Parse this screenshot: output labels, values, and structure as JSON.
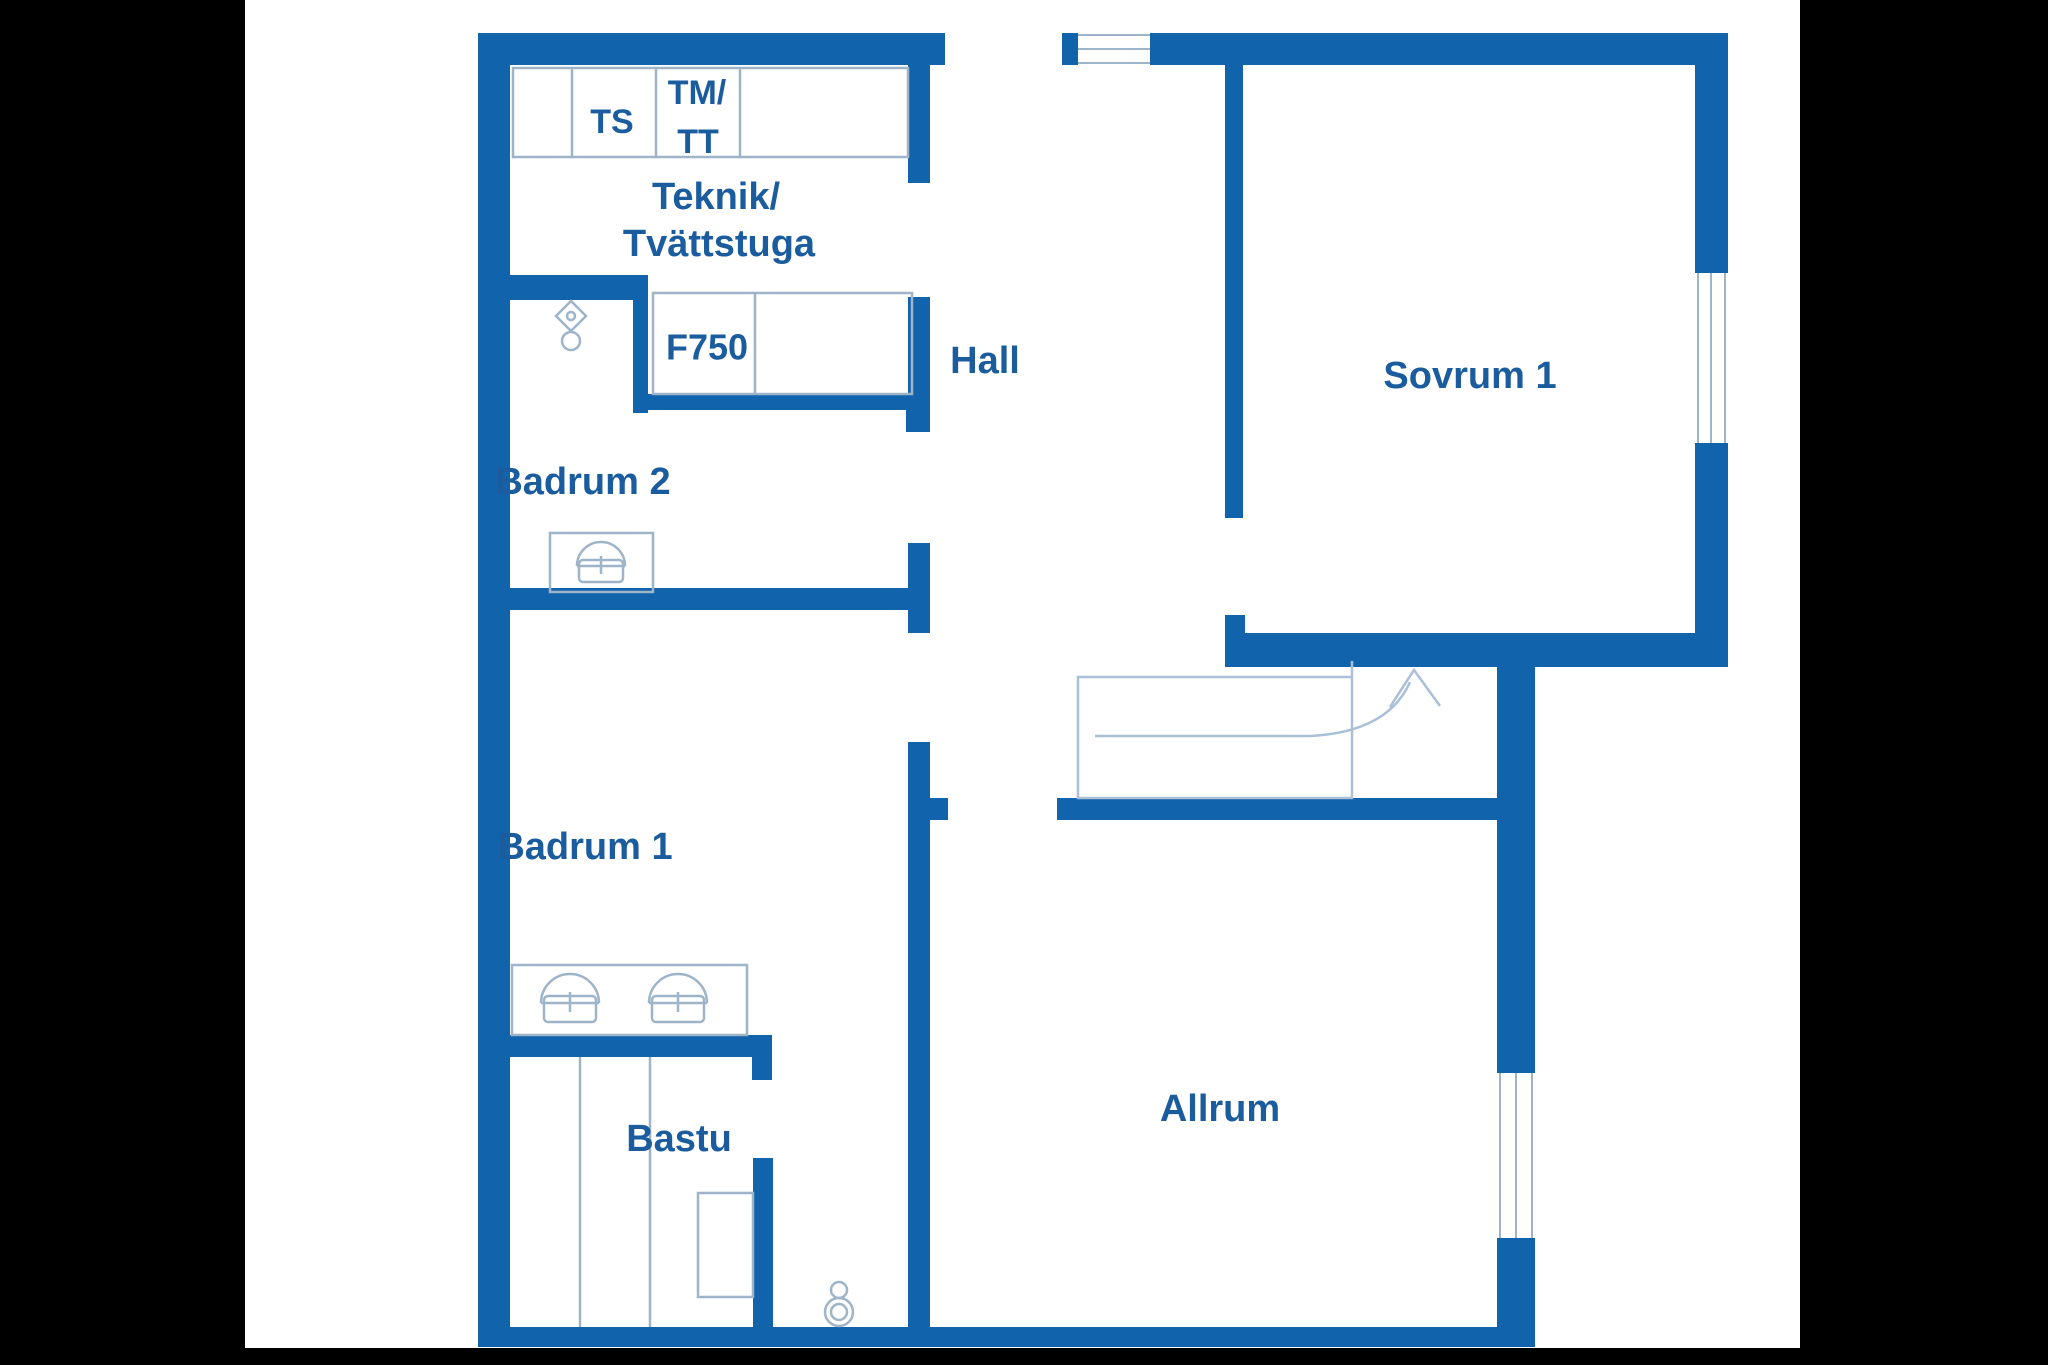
{
  "document": {
    "type": "floor-plan-drawing",
    "style": "blue line drawing on white, letterboxed with black bars"
  },
  "colors": {
    "wall": "#1163ac",
    "text": "#1b5c9e",
    "thin_outline": "#9db4c9",
    "stair_line": "#a9c0d6",
    "background": "#ffffff",
    "letterbox": "#000000"
  },
  "labels": {
    "teknik_line1": "Teknik/",
    "teknik_line2": "Tvättstuga",
    "hall": "Hall",
    "sovrum1": "Sovrum 1",
    "badrum2": "Badrum 2",
    "badrum1": "Badrum 1",
    "bastu": "Bastu",
    "allrum": "Allrum",
    "cab_ts": "TS",
    "cab_tm": "TM/",
    "cab_tt": "TT",
    "f750": "F750"
  },
  "rooms": [
    {
      "id": "teknik-tvattstuga",
      "label": "Teknik/Tvättstuga"
    },
    {
      "id": "hall",
      "label": "Hall"
    },
    {
      "id": "sovrum-1",
      "label": "Sovrum 1"
    },
    {
      "id": "badrum-2",
      "label": "Badrum 2"
    },
    {
      "id": "badrum-1",
      "label": "Badrum 1"
    },
    {
      "id": "bastu",
      "label": "Bastu"
    },
    {
      "id": "allrum",
      "label": "Allrum"
    }
  ],
  "fixtures": [
    {
      "id": "toilet-badrum-2",
      "icon": "toilet-icon"
    },
    {
      "id": "wc-near-bastu",
      "icon": "toilet-icon"
    },
    {
      "id": "sink-badrum-2",
      "icon": "sink-icon"
    },
    {
      "id": "sink-badrum-1-left",
      "icon": "sink-icon"
    },
    {
      "id": "sink-badrum-1-right",
      "icon": "sink-icon"
    },
    {
      "id": "sauna-heater",
      "icon": "heater-icon"
    },
    {
      "id": "staircase",
      "icon": "stairs-up-arrow-icon"
    }
  ],
  "windows": [
    {
      "id": "window-top-wall",
      "wall": "north"
    },
    {
      "id": "window-sovrum1-east",
      "wall": "east-upper"
    },
    {
      "id": "window-allrum-east",
      "wall": "east-lower"
    }
  ],
  "doors": [
    {
      "id": "entry-opening-top",
      "location": "north wall, left of hall window"
    },
    {
      "id": "door-teknik",
      "location": "center wall y183-297"
    },
    {
      "id": "door-badrum2",
      "location": "center wall y432-543"
    },
    {
      "id": "door-badrum1",
      "location": "center wall y633-742"
    },
    {
      "id": "door-sovrum1",
      "location": "hall divider y518-615"
    },
    {
      "id": "door-allrum",
      "location": "below stairs"
    },
    {
      "id": "door-bastu",
      "location": "bastu east wall"
    }
  ]
}
